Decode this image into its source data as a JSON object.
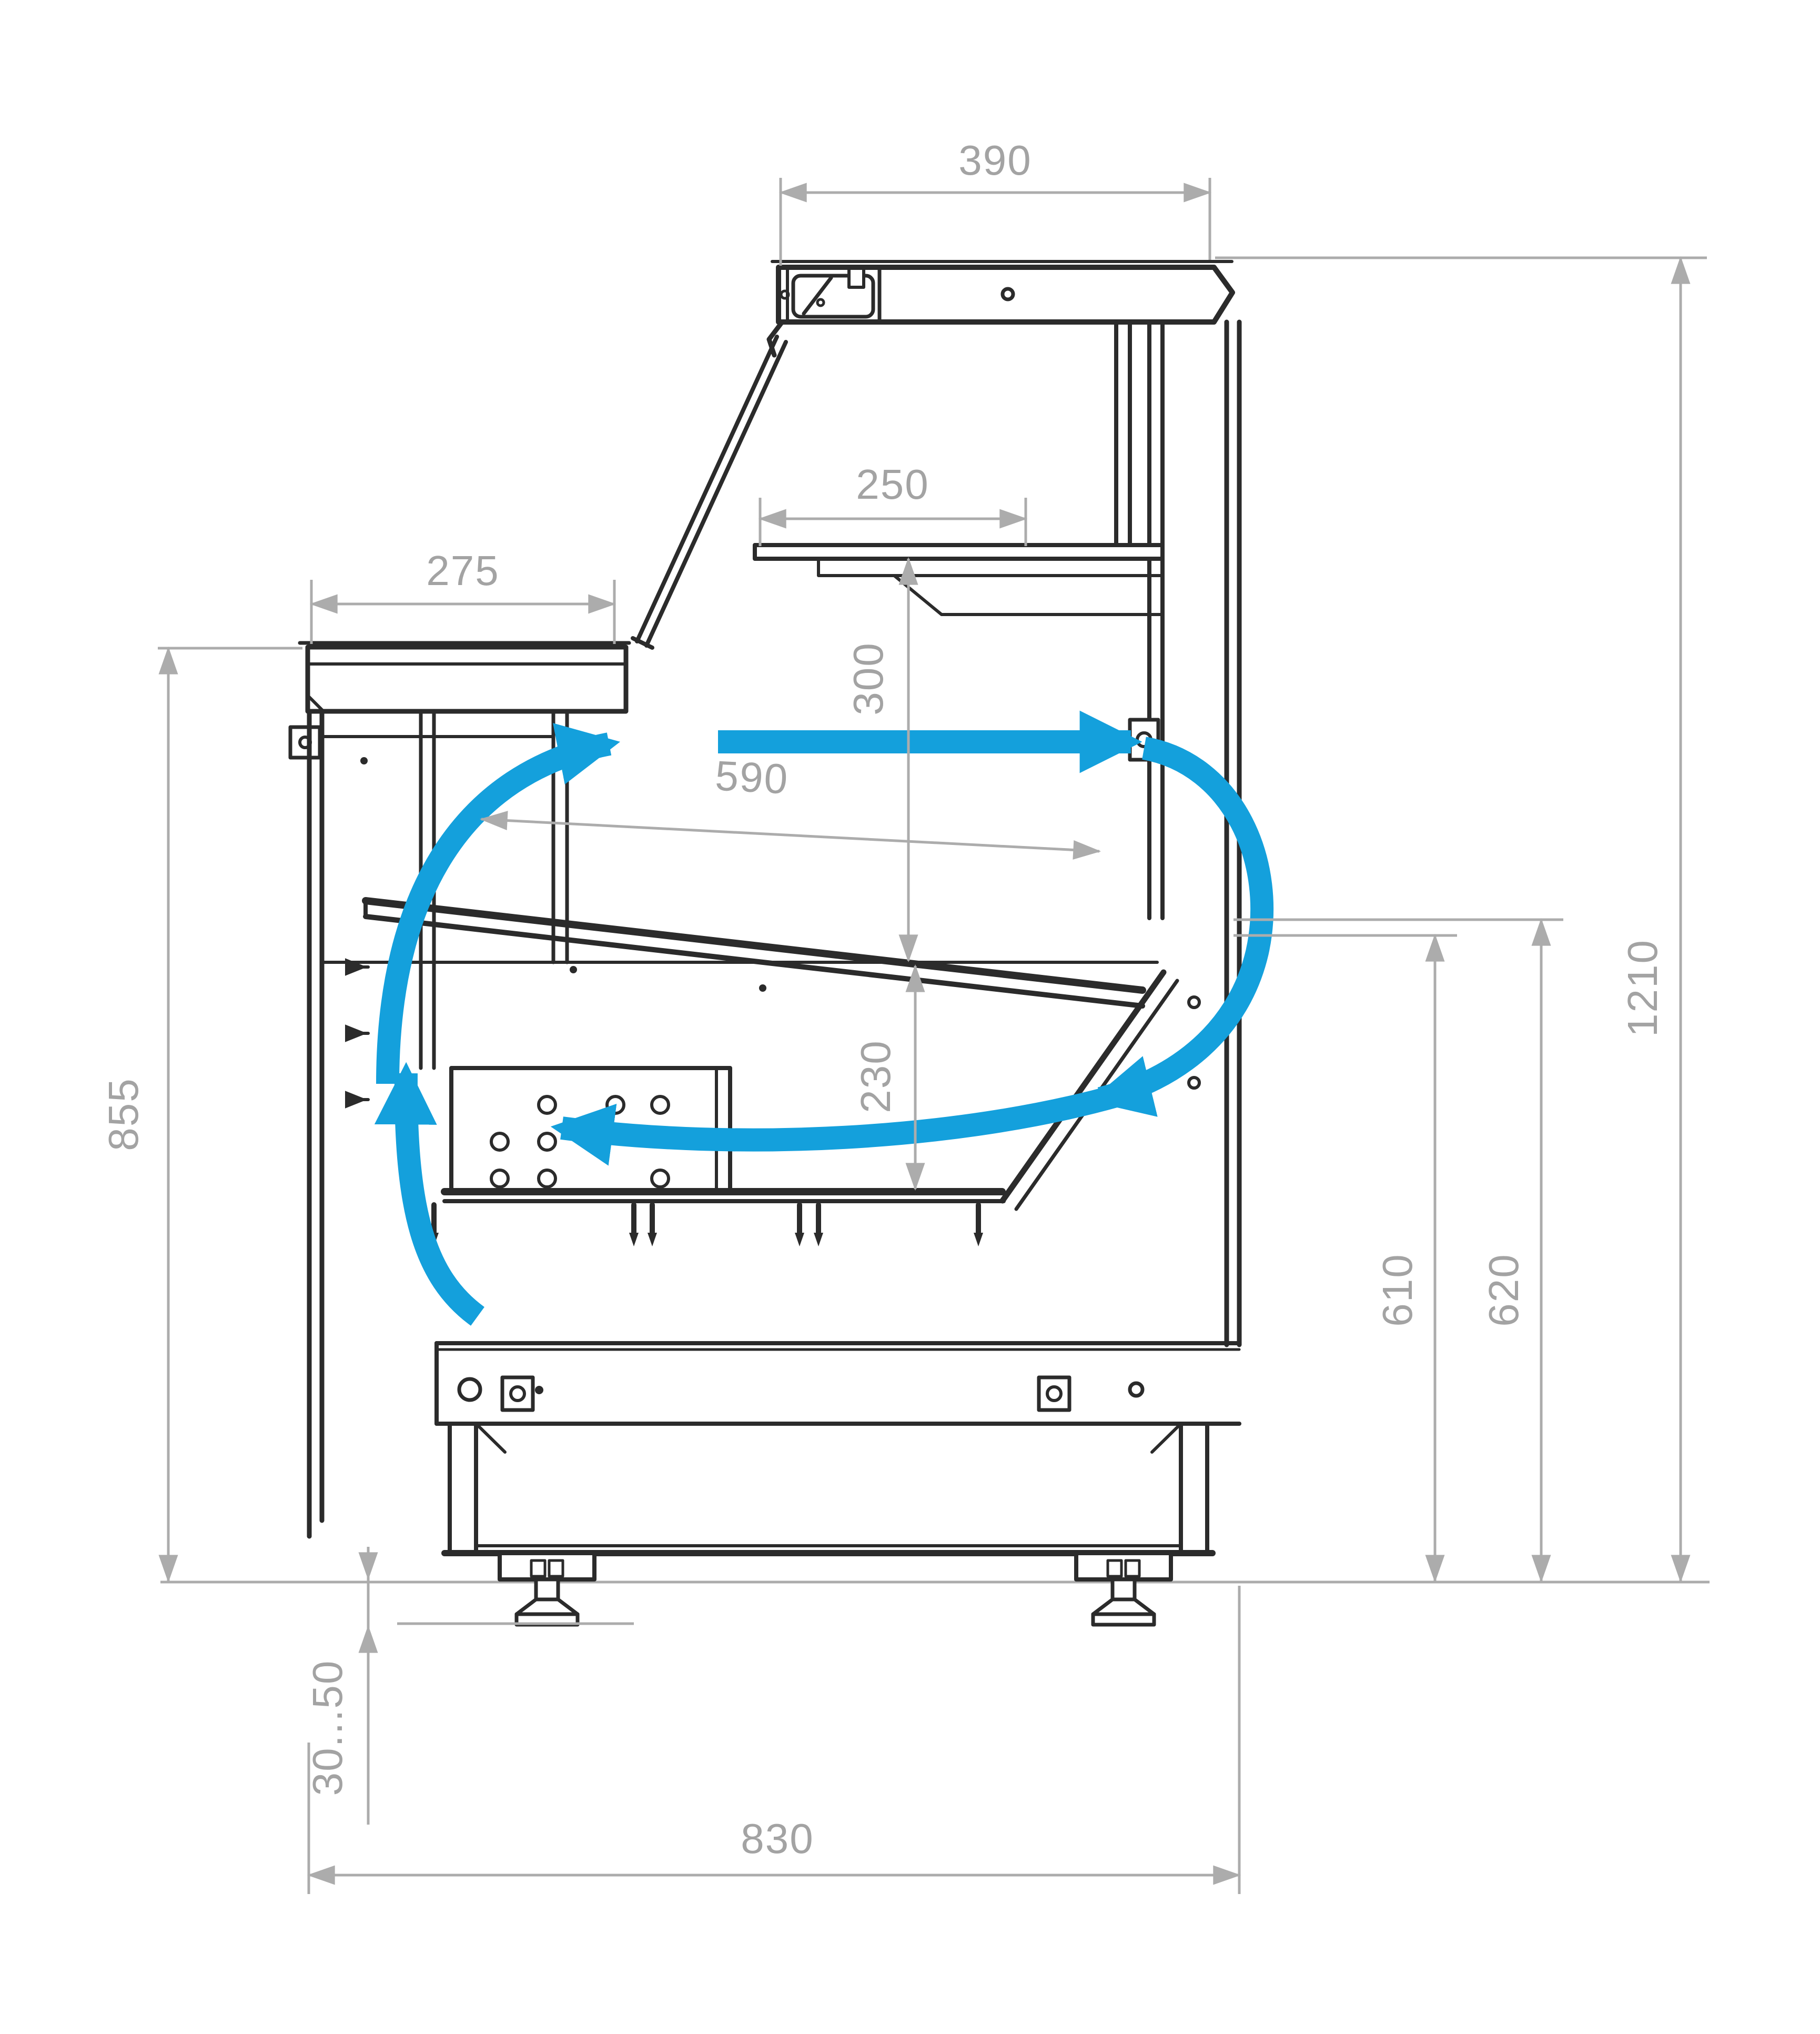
{
  "colors": {
    "line": "#2b2b2b",
    "dimension": "#acacac",
    "dimension_text": "#a3a3a3",
    "airflow": "#14a0dc",
    "background": "#ffffff"
  },
  "dimensions": {
    "canopy_width": {
      "label": "390",
      "orientation": "horizontal"
    },
    "shelf_width": {
      "label": "250",
      "orientation": "horizontal"
    },
    "counter_depth": {
      "label": "275",
      "orientation": "horizontal"
    },
    "display_opening": {
      "label": "590",
      "orientation": "slanted"
    },
    "shelf_clearance": {
      "label": "300",
      "orientation": "vertical"
    },
    "well_depth": {
      "label": "230",
      "orientation": "vertical"
    },
    "counter_height": {
      "label": "855",
      "orientation": "vertical"
    },
    "rear_height_inner": {
      "label": "610",
      "orientation": "vertical"
    },
    "rear_height_outer": {
      "label": "620",
      "orientation": "vertical"
    },
    "overall_height": {
      "label": "1210",
      "orientation": "vertical"
    },
    "leg_adjust_range": {
      "label": "30...50",
      "orientation": "vertical"
    },
    "base_depth": {
      "label": "830",
      "orientation": "horizontal"
    }
  },
  "airflow": {
    "arrows": [
      "airflow-top-straight-arrow",
      "airflow-right-arc-arrow",
      "airflow-bottom-return-arrow",
      "airflow-left-rise-arrow",
      "airflow-under-counter-arrow"
    ],
    "vent_arrow_count": 3
  }
}
